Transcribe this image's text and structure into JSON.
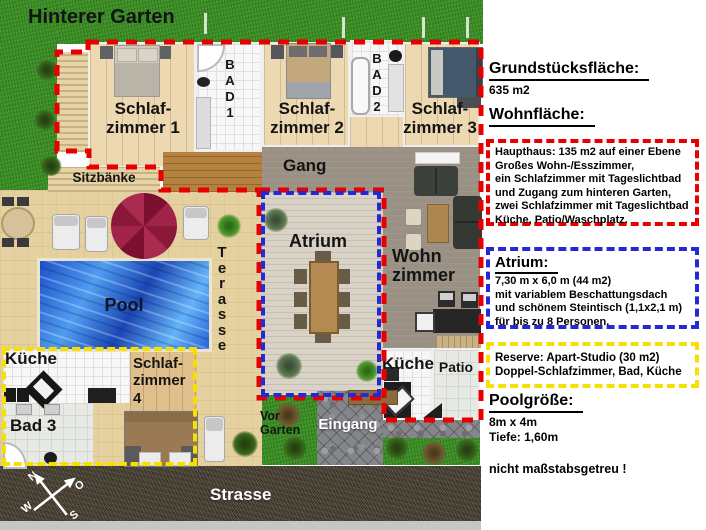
{
  "plan": {
    "areas": {
      "hinterer_garten": "Hinterer Garten",
      "sitzbaenke": "Sitzbänke",
      "terasse_vertical": "T\ne\nr\na\ns\ns\ne",
      "pool": "Pool",
      "strasse": "Strasse",
      "eingang": "Eingang",
      "vor_garten": "Vor\nGarten",
      "gang": "Gang",
      "atrium": "Atrium",
      "wohnzimmer": "Wohn\nzimmer",
      "kueche_haupthaus": "Küche",
      "patio": "Patio",
      "schlafzimmer1": "Schlaf-\nzimmer 1",
      "schlafzimmer2": "Schlaf-\nzimmer 2",
      "schlafzimmer3": "Schlaf-\nzimmer 3",
      "schlafzimmer4": "Schlaf-\nzimmer\n4",
      "bad1": "B\nA\nD\n1",
      "bad2": "B\nA\nD\n2",
      "bad3": "Bad 3",
      "kueche_studio": "Küche"
    },
    "compass": {
      "n": "N",
      "o": "O",
      "w": "W",
      "s": "S"
    }
  },
  "panel": {
    "grundstueck": {
      "heading": "Grundstücksfläche:",
      "value": "635 m2"
    },
    "wohnflaeche_heading": "Wohnfläche:",
    "haupthaus_box": "Haupthaus: 135 m2 auf einer Ebene\nGroßes Wohn-/Esszimmer,\nein Schlafzimmer mit Tageslichtbad\nund Zugang zum hinteren Garten,\nzwei Schlafzimmer mit Tageslichtbad\nKüche, Patio/Waschplatz.",
    "atrium_box": {
      "heading": "Atrium:",
      "body": "7,30 m x 6,0 m (44 m2)\nmit variablem Beschattungsdach\nund schönem Steintisch (1,1x2,1 m)\nfür bis zu 8 Personen."
    },
    "reserve_box": "Reserve: Apart-Studio (30 m2)\nDoppel-Schlafzimmer, Bad, Küche",
    "pool": {
      "heading": "Poolgröße:",
      "size": "8m x 4m",
      "depth": "Tiefe: 1,60m"
    },
    "disclaimer": "nicht maßstabsgetreu !"
  },
  "colors": {
    "haupthaus_outline": "#e80000",
    "atrium_outline": "#2329d6",
    "reserve_outline": "#f6e000",
    "grass": "#3c8f27",
    "pool_water": "#2a62d8",
    "street": "#4a4338"
  }
}
